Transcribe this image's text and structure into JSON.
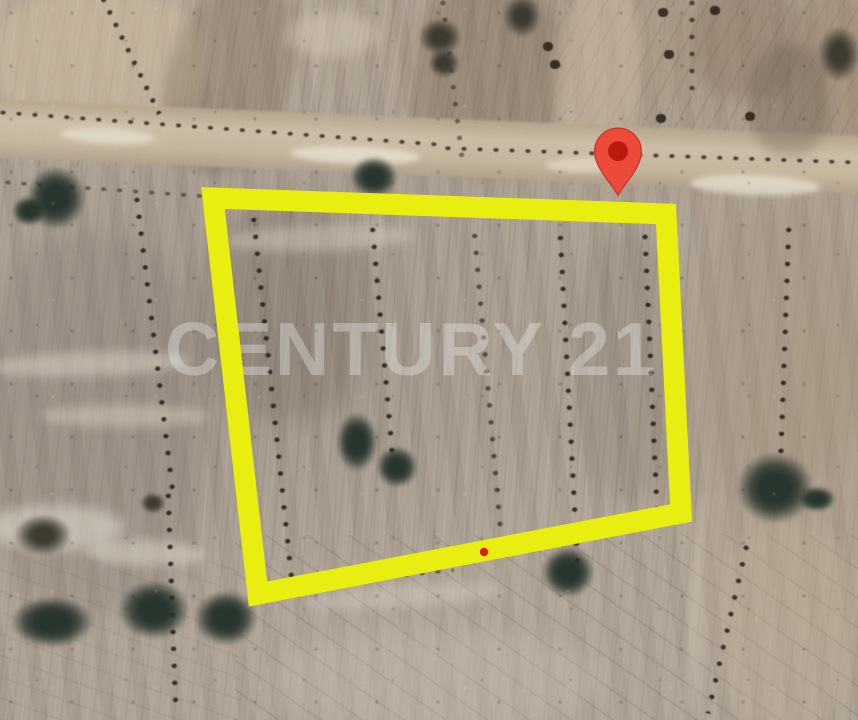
{
  "map": {
    "kind": "satellite-view",
    "description": "Aerial satellite photo of plowed farmland parcels with tree rows, a dirt road, a highlighted land plot outlined in yellow and a red location pin"
  },
  "watermark": {
    "text": "CENTURY 21",
    "color": "rgba(255,255,255,0.30)"
  },
  "boundary": {
    "shape": "quadrilateral",
    "color": "#e8ee10",
    "stroke_width": "21",
    "points": "213,198 666,214 681,513 258,594"
  },
  "marker": {
    "body_color": "#ed4a39",
    "core_color": "#bb1a0e",
    "outline_color": "#c43829",
    "pin_path": "M12 1 C6 1 1.2 5.8 1.2 11.8 C1.2 16.5 4.5 21.5 7.3 25.2 C9.3 27.8 11 29.9 12 32 C13 29.9 14.7 27.8 16.7 25.2 C19.5 21.5 22.8 16.5 22.8 11.8 C22.8 5.8 18 1 12 1 Z"
  },
  "annotation_dot": {
    "color": "#de1e0d",
    "cx": "484",
    "cy": "552",
    "r": "4.2"
  },
  "terrain_colors": {
    "field_base": "#aca092",
    "field_light": "#cbbda6",
    "field_dark": "#9d8b7a",
    "road": "#cfc1aa",
    "tree": "#27352c",
    "bush": "#2a2218"
  }
}
